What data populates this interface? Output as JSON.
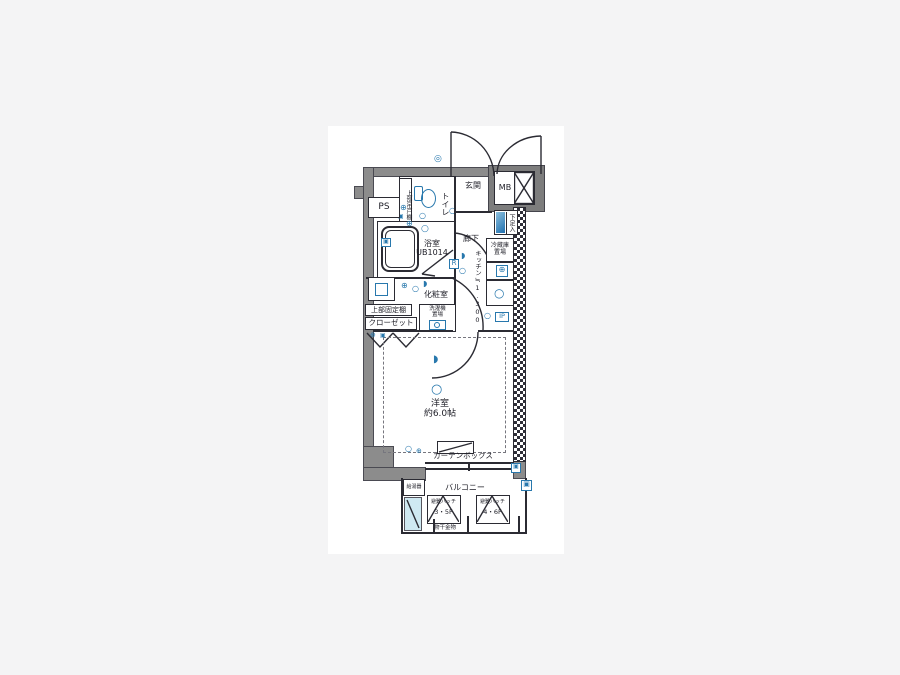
{
  "colors": {
    "background": "#f4f4f5",
    "canvas": "#ffffff",
    "wall_gray": "#8c8c8c",
    "wall_dark_gray": "#7d7d7d",
    "line_dark": "#2b2b33",
    "fixture_blue": "#2878ad",
    "fixture_blue_light": "#cfe9f2"
  },
  "plan": {
    "rooms": {
      "pipe_space": "PS",
      "entrance": "玄関",
      "meter_box": "MB",
      "toilet": "トイレ",
      "toilet_upper_shelf": "上部吊戸棚",
      "bathroom_name": "浴室",
      "bathroom_size": "UB1014",
      "hallway": "廊下",
      "shoe_cabinet": "下足入",
      "fridge_space_line1": "冷蔵庫",
      "fridge_space_line2": "置場",
      "kitchen": "キッチン≒1.300",
      "powder_room": "化粧室",
      "closet_upper_shelf": "上部固定棚",
      "closet": "クローゼット",
      "washer_line1": "洗濯機",
      "washer_line2": "置場",
      "main_room_name": "洋室",
      "main_room_size": "約6.0帖",
      "curtain_box": "カーテンボックス",
      "balcony": "バルコニー",
      "hatch_front_name": "避難ハッチ",
      "hatch_front_floors": "3・5F",
      "hatch_rear_name": "避難ハッチ",
      "hatch_rear_floors": "4・6F",
      "laundry_fitting": "物干金物",
      "water_heater": "給湯器"
    },
    "symbols": {
      "r_box": "R",
      "ip_box": "IP",
      "ceiling_light": "○",
      "outlet": "⊕",
      "vent": "▣",
      "downlight": "◗",
      "sensor_light": "◎"
    }
  }
}
